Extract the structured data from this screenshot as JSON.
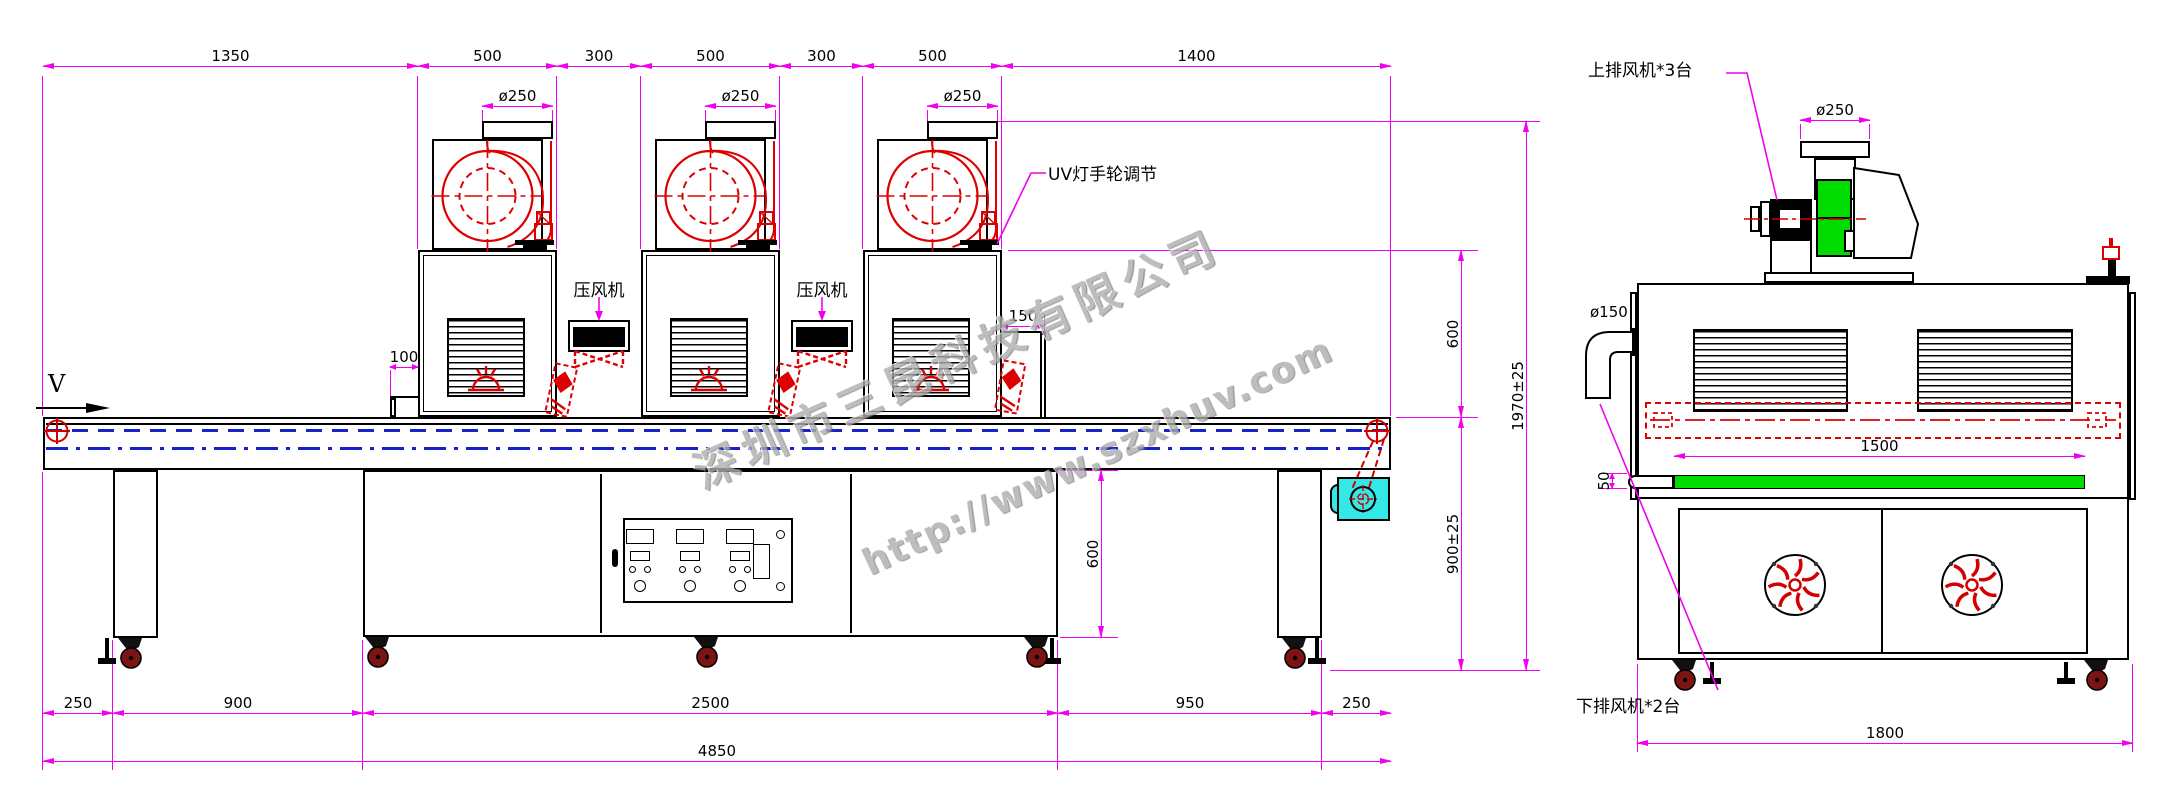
{
  "side_view": {
    "top_dims": [
      "1350",
      "500",
      "300",
      "500",
      "300",
      "500",
      "1400"
    ],
    "fan_outlet_diameter": "ø250",
    "inlet_gap": "100",
    "outlet_gap": "150",
    "lamp_to_belt_height": "600",
    "total_height": "1970±25",
    "belt_height": "900±25",
    "stand_height": "600",
    "bottom_dims": [
      "250",
      "900",
      "2500",
      "950",
      "250"
    ],
    "overall_length": "4850",
    "labels": {
      "uv_lamp_handwheel": "UV灯手轮调节",
      "pressure_fan": "压风机",
      "belt_direction": "V"
    }
  },
  "end_view": {
    "labels": {
      "upper_exhaust_fans": "上排风机*3台",
      "lower_exhaust_fans": "下排风机*2台"
    },
    "outlet_diameter": "ø250",
    "lamp_length": "1500",
    "belt_offset": "50",
    "duct_diameter": "ø150",
    "overall_width": "1800"
  },
  "watermark": {
    "company": "深圳市三昆科技有限公司",
    "website": "http://www.szxhuv.com"
  },
  "colors": {
    "dimension": "#f000f0",
    "machine_red": "#dd0000",
    "belt_blue": "#1722cc",
    "motor_cyan": "#35e8e8",
    "fan_green": "#00dc00"
  }
}
